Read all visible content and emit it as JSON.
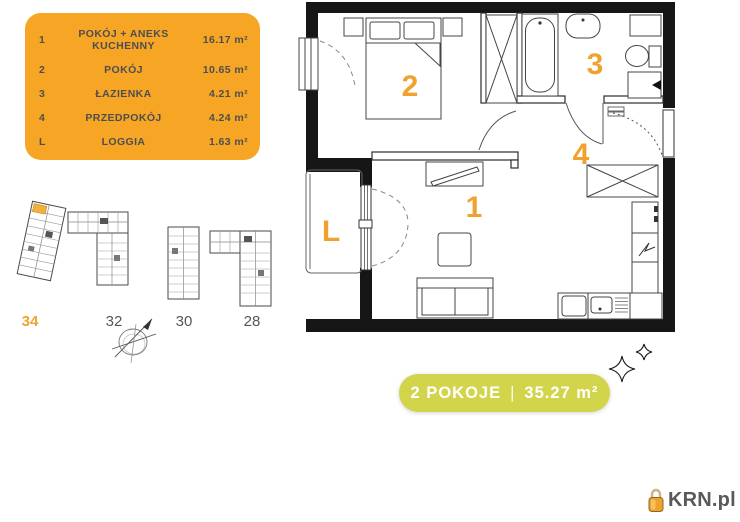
{
  "legend": {
    "bg_color": "#F6A624",
    "text_color": "#4E4E50",
    "items": [
      {
        "num": "1",
        "name": "POKÓJ + ANEKS KUCHENNY",
        "area": "16.17 m²"
      },
      {
        "num": "2",
        "name": "POKÓJ",
        "area": "10.65 m²"
      },
      {
        "num": "3",
        "name": "ŁAZIENKA",
        "area": "4.21 m²"
      },
      {
        "num": "4",
        "name": "PRZEDPOKÓJ",
        "area": "4.24 m²"
      },
      {
        "num": "L",
        "name": "LOGGIA",
        "area": "1.63 m²"
      }
    ]
  },
  "floor_plan": {
    "label_color": "#EFA32E",
    "room_labels": [
      {
        "id": "1"
      },
      {
        "id": "2"
      },
      {
        "id": "3"
      },
      {
        "id": "4"
      },
      {
        "id": "L"
      }
    ]
  },
  "site_plan": {
    "highlight_color": "#EFA32E",
    "buildings": [
      {
        "label": "34",
        "highlighted": true
      },
      {
        "label": "32",
        "highlighted": false
      },
      {
        "label": "30",
        "highlighted": false
      },
      {
        "label": "28",
        "highlighted": false
      }
    ]
  },
  "badge": {
    "rooms_label": "2 POKOJE",
    "separator": "|",
    "area_label": "35.27 m²",
    "bg_color": "#D2D44B",
    "text_color": "#FFFFFF"
  },
  "logo": {
    "text": "KRN.pl",
    "icon": "padlock-icon",
    "icon_color": "#F0A22C"
  }
}
